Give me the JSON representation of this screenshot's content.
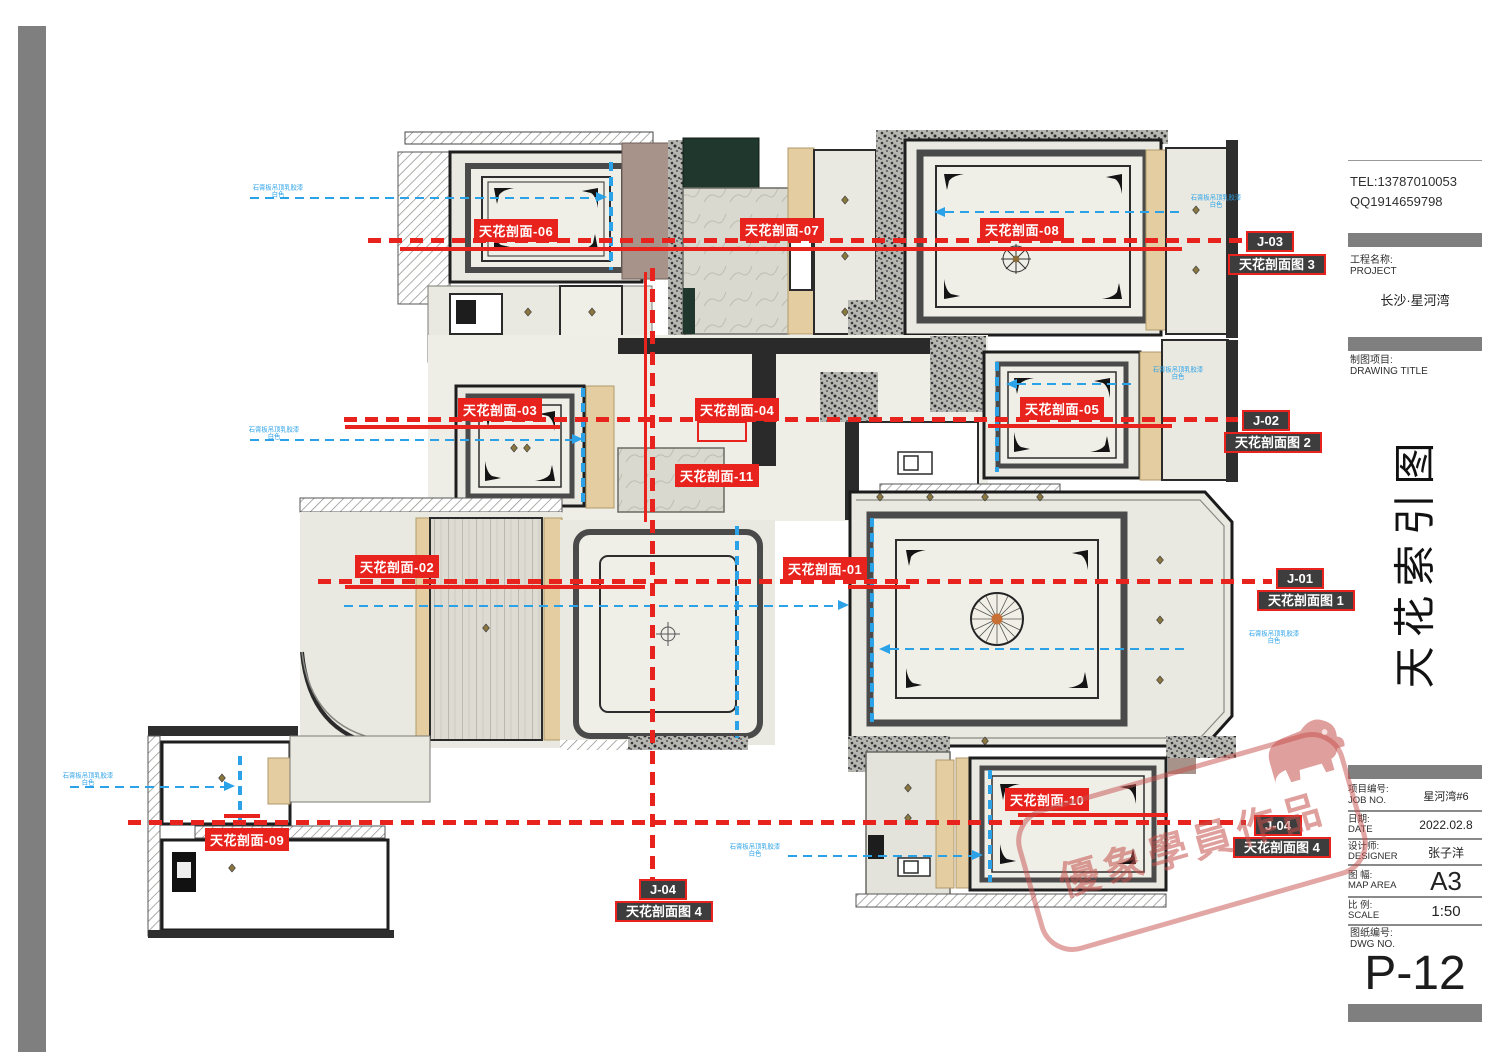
{
  "colors": {
    "accent_red": "#e8231d",
    "note_blue": "#2ba2e8",
    "stamp_red": "#c5504b"
  },
  "plan": {
    "section_labels": [
      {
        "text": "天花剖面-01"
      },
      {
        "text": "天花剖面-02"
      },
      {
        "text": "天花剖面-03"
      },
      {
        "text": "天花剖面-04"
      },
      {
        "text": "天花剖面-05"
      },
      {
        "text": "天花剖面-06"
      },
      {
        "text": "天花剖面-07"
      },
      {
        "text": "天花剖面-08"
      },
      {
        "text": "天花剖面-09"
      },
      {
        "text": "天花剖面-10"
      },
      {
        "text": "天花剖面-11"
      }
    ],
    "index_markers": [
      {
        "id": "J-03",
        "fig": "天花剖面图 3"
      },
      {
        "id": "J-02",
        "fig": "天花剖面图 2"
      },
      {
        "id": "J-01",
        "fig": "天花剖面图 1"
      },
      {
        "id": "J-04",
        "fig": "天花剖面图 4"
      },
      {
        "id": "J-04",
        "fig": "天花剖面图 4"
      }
    ],
    "blue_note": {
      "line1": "石膏板吊顶乳胶漆",
      "line2": "白色"
    }
  },
  "title_block": {
    "tel": "TEL:13787010053",
    "qq": "QQ1914659798",
    "project_label_zh": "工程名称:",
    "project_label_en": "PROJECT",
    "project_name": "长沙·星河湾",
    "drawing_label_zh": "制图项目:",
    "drawing_label_en": "DRAWING TITLE",
    "drawing_title": "天花索引图",
    "rows": [
      {
        "zh": "项目编号:",
        "en": "JOB NO.",
        "value": "星河湾#6"
      },
      {
        "zh": "日期:",
        "en": "DATE",
        "value": "2022.02.8"
      },
      {
        "zh": "设计师:",
        "en": "DESIGNER",
        "value": "张子洋"
      },
      {
        "zh": "图 幅:",
        "en": "MAP AREA",
        "value": "A3"
      },
      {
        "zh": "比 例:",
        "en": "SCALE",
        "value": "1:50"
      },
      {
        "zh": "图纸编号:",
        "en": "DWG NO.",
        "value": "P-12"
      }
    ]
  },
  "stamp": {
    "text": "優象學員作品"
  }
}
